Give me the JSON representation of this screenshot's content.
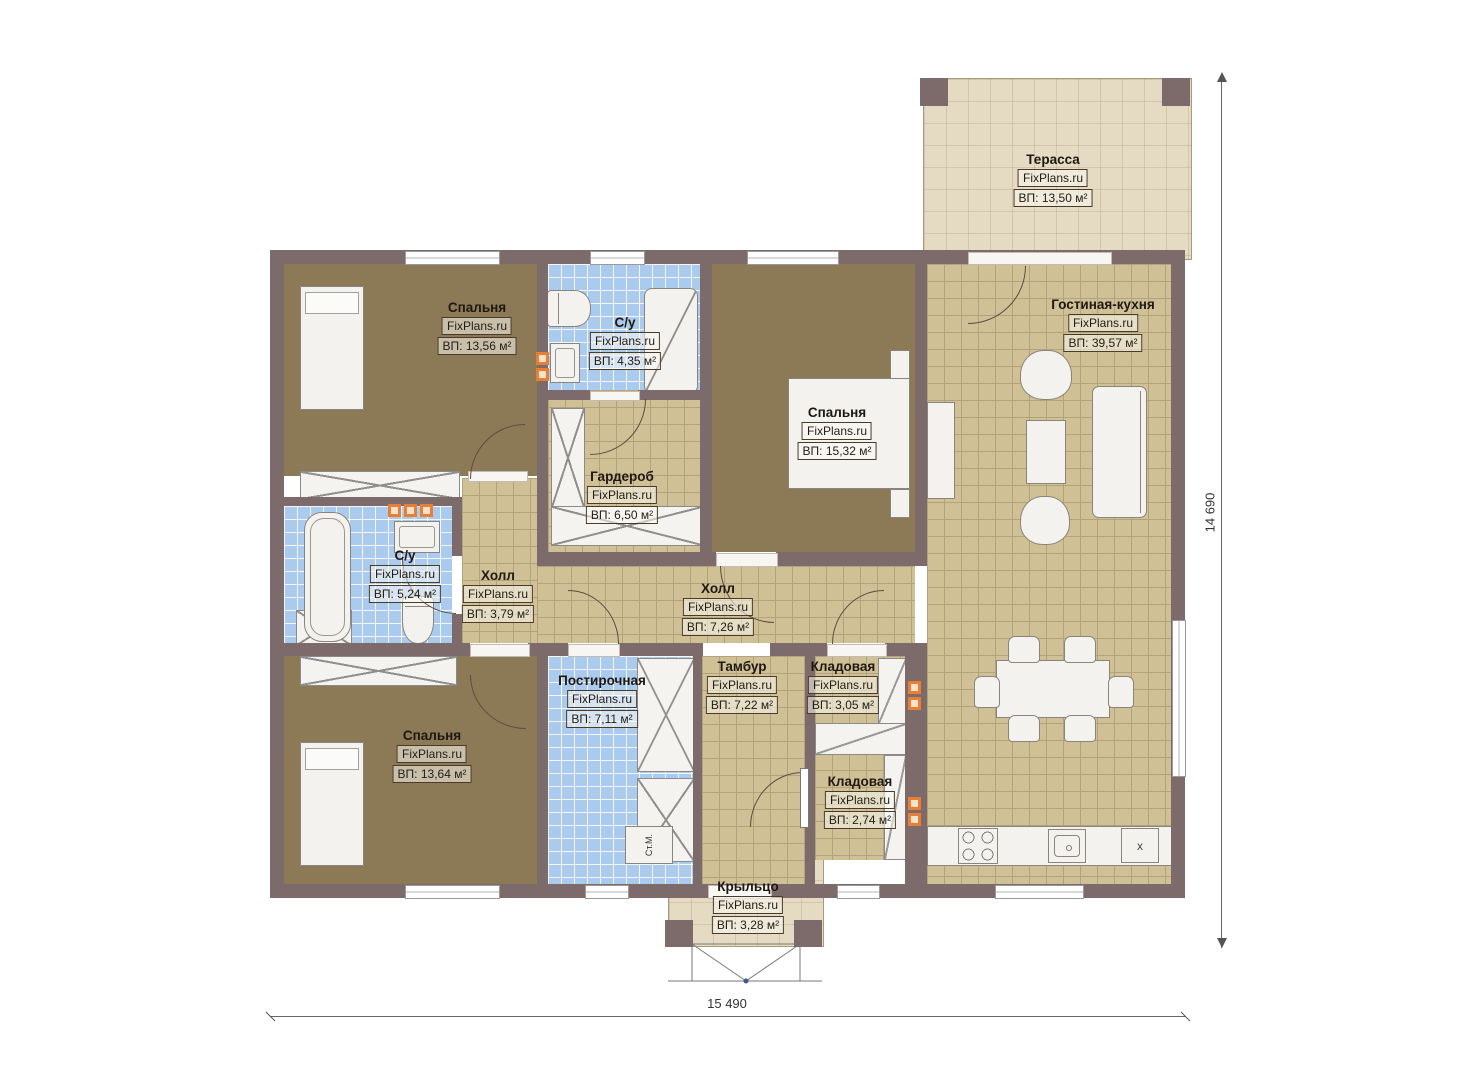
{
  "brand": "FixPlans.ru",
  "rooms": [
    {
      "name": "Терасса",
      "area": "ВП: 13,50 м²"
    },
    {
      "name": "Спальня",
      "area": "ВП: 13,56 м²"
    },
    {
      "name": "С/у",
      "area": "ВП: 4,35 м²"
    },
    {
      "name": "Спальня",
      "area": "ВП: 15,32 м²"
    },
    {
      "name": "Гостиная-кухня",
      "area": "ВП: 39,57 м²"
    },
    {
      "name": "Гардероб",
      "area": "ВП: 6,50 м²"
    },
    {
      "name": "С/у",
      "area": "ВП: 5,24 м²"
    },
    {
      "name": "Холл",
      "area": "ВП: 3,79 м²"
    },
    {
      "name": "Холл",
      "area": "ВП: 7,26 м²"
    },
    {
      "name": "Спальня",
      "area": "ВП: 13,64 м²"
    },
    {
      "name": "Постирочная",
      "area": "ВП: 7,11 м²"
    },
    {
      "name": "Тамбур",
      "area": "ВП: 7,22 м²"
    },
    {
      "name": "Кладовая",
      "area": "ВП: 3,05 м²"
    },
    {
      "name": "Кладовая",
      "area": "ВП: 2,74 м²"
    },
    {
      "name": "Крыльцо",
      "area": "ВП: 3,28 м²"
    }
  ],
  "dimensions": {
    "width": "15 490",
    "height": "14 690"
  },
  "labels": {
    "washer": "Ст.М.",
    "fridge": "x"
  },
  "colors": {
    "wall": "#7d6a6a",
    "floor_wood": "#8c7a56",
    "tile_tan": "#cfc096",
    "tile_blue": "#abcbee",
    "slab": "#e4dbc2",
    "accent_orange": "#e8803c"
  }
}
